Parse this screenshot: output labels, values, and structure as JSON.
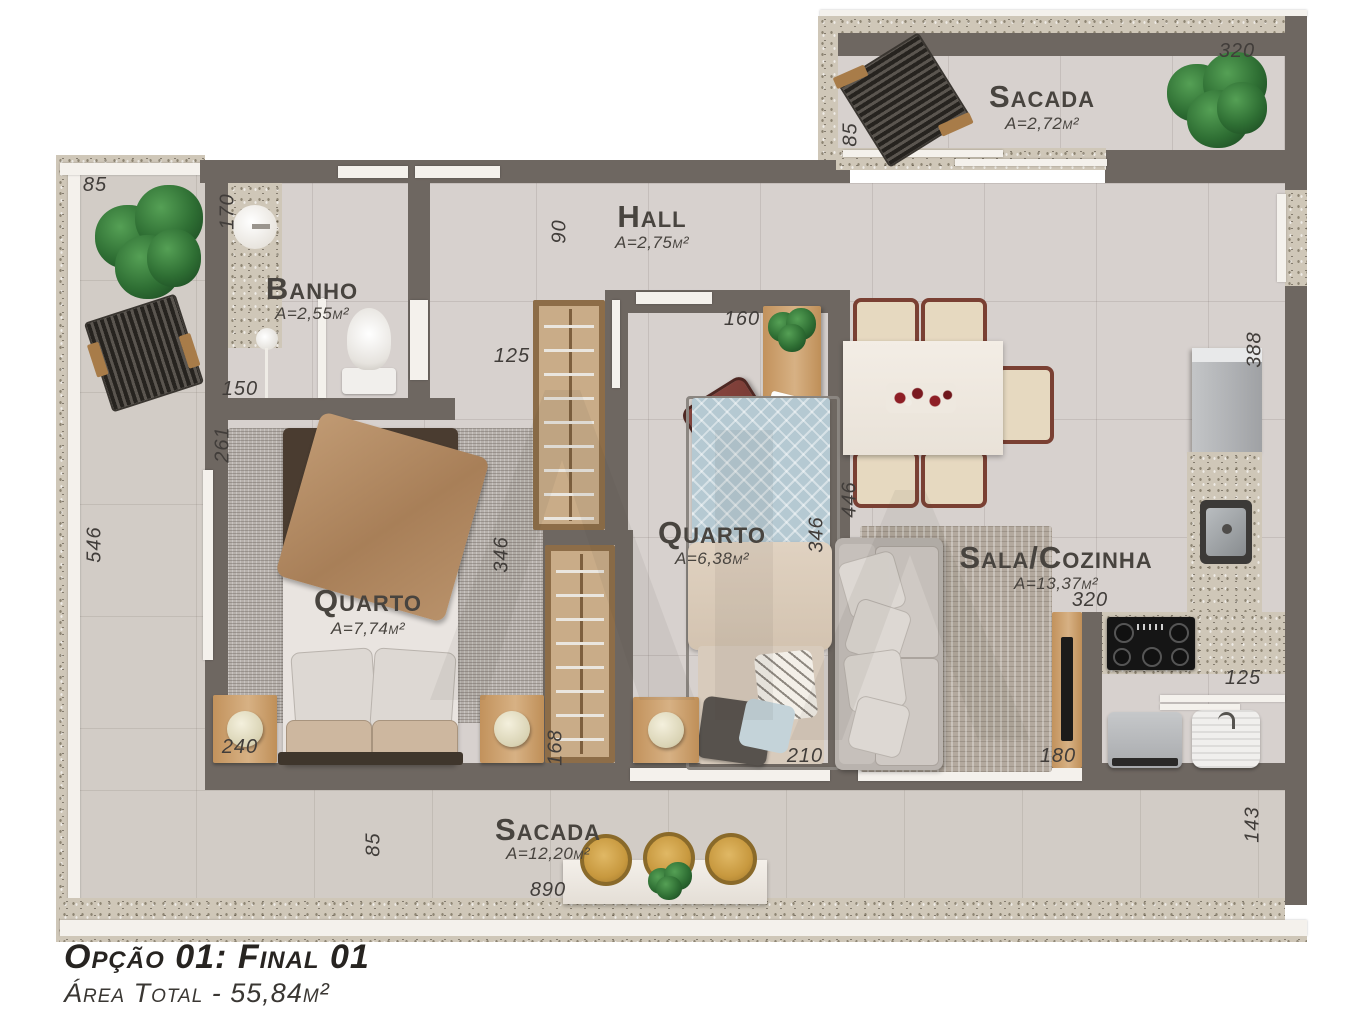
{
  "footer": {
    "title": "Opção 01: Final 01",
    "subtitle": "Área Total - 55,84m²"
  },
  "rooms": {
    "sacada_top": {
      "name": "Sacada",
      "area": "A=2,72m²"
    },
    "hall": {
      "name": "Hall",
      "area": "A=2,75m²"
    },
    "banho": {
      "name": "Banho",
      "area": "A=2,55m²"
    },
    "quarto1": {
      "name": "Quarto",
      "area": "A=7,74m²"
    },
    "quarto2": {
      "name": "Quarto",
      "area": "A=6,38m²"
    },
    "sala": {
      "name": "Sala/Cozinha",
      "area": "A=13,37m²"
    },
    "sacada_bottom": {
      "name": "Sacada",
      "area": "A=12,20m²"
    }
  },
  "dims": {
    "st_width": "320",
    "st_depth": "85",
    "bal_top": "85",
    "banho_w": "170",
    "banho_l": "150",
    "hall_w": "90",
    "q1_top": "261",
    "bal_len": "546",
    "q1_w": "240",
    "q1_len": "346",
    "ward_top": "125",
    "ward_len": "346",
    "ward_bot": "168",
    "q2_top": "160",
    "q2_len": "346",
    "q2_w": "210",
    "sala_len": "446",
    "sala_right": "388",
    "tv_wall": "320",
    "tv_panel": "180",
    "kitchen_win": "125",
    "sac_right": "143",
    "sac_depth": "85",
    "sac_width": "890"
  },
  "colors": {
    "wall": "#6e6761",
    "floor": "#d7d1ce",
    "balcony_floor": "#d2ccc6",
    "granite": "#cfc7b8",
    "wood": "#c89a64",
    "plant_green": "#2e6e33",
    "label_text": "#48443f"
  }
}
